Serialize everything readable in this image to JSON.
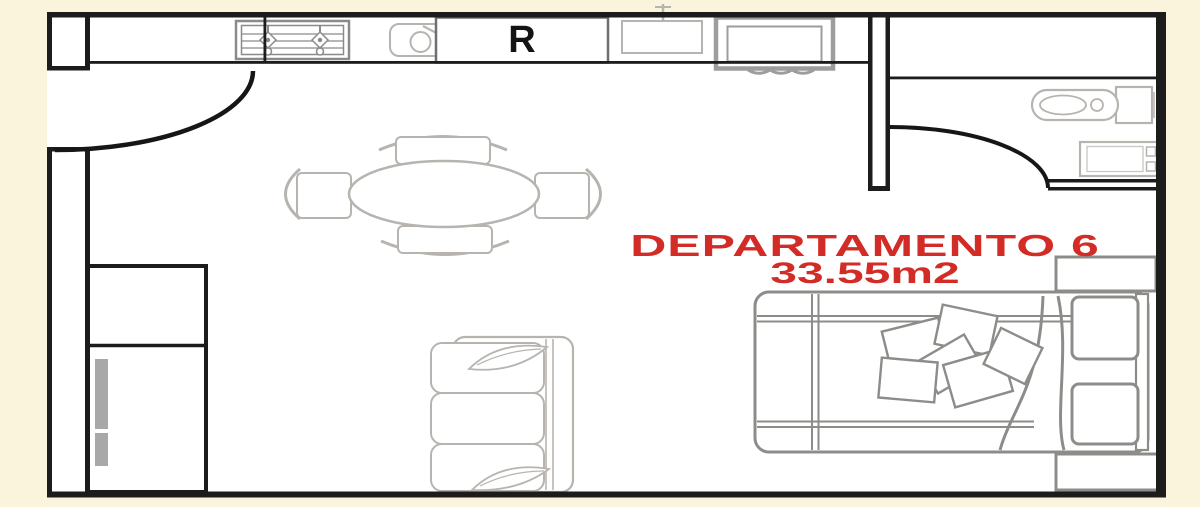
{
  "labels": {
    "unit": "DEPARTAMENTO 6",
    "area": "33.55m2",
    "refrigerator": "R"
  },
  "colors": {
    "canvas_background": "#fbf4dc",
    "floor": "#ffffff",
    "walls": "#1c1c1c",
    "furniture_dark_gray": "#8e8c89",
    "furniture_light_gray": "#b7b4b0",
    "appliance_gray": "#9d9d9d",
    "label_red": "#d32b25",
    "refrigerator_label_black": "#141414"
  },
  "furniture": [
    {
      "name": "stove-icon",
      "area": "kitchen"
    },
    {
      "name": "prep-sink-icon",
      "area": "kitchen"
    },
    {
      "name": "refrigerator",
      "area": "kitchen"
    },
    {
      "name": "kitchen-sink-icon",
      "area": "kitchen"
    },
    {
      "name": "washing-machine-icon",
      "area": "kitchen"
    },
    {
      "name": "toilet-icon",
      "area": "bathroom"
    },
    {
      "name": "bathroom-sink-icon",
      "area": "bathroom"
    },
    {
      "name": "dining-table-with-chairs",
      "area": "living"
    },
    {
      "name": "sofa",
      "area": "living"
    },
    {
      "name": "closet",
      "area": "living"
    },
    {
      "name": "bed",
      "area": "bedroom"
    },
    {
      "name": "nightstand-top",
      "area": "bedroom"
    },
    {
      "name": "nightstand-bottom",
      "area": "bedroom"
    }
  ]
}
